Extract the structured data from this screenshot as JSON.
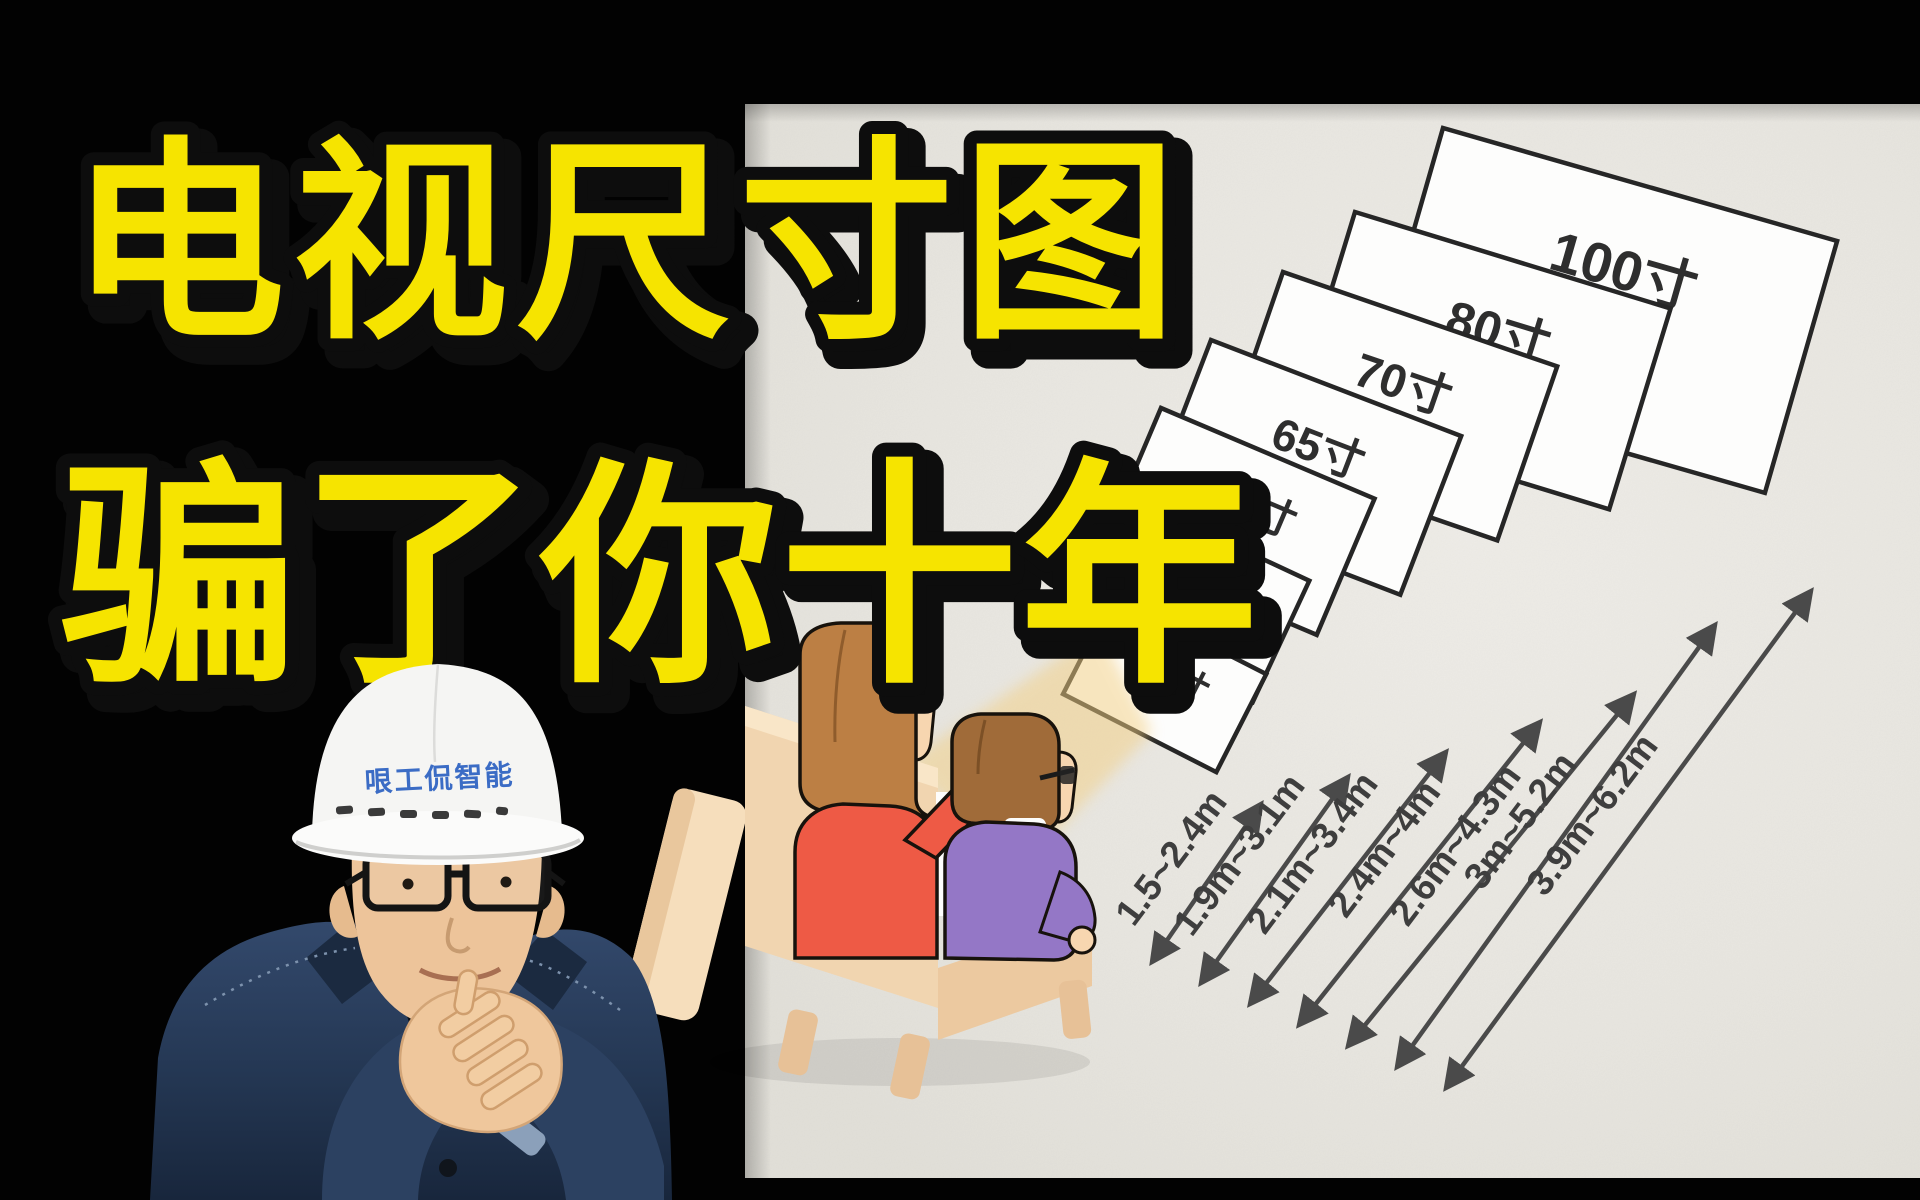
{
  "header": {
    "title_line1": "电视尺寸图",
    "title_line2": "骗了你十年"
  },
  "presenter": {
    "hard_hat_text": "哏工侃智能"
  },
  "diagram": {
    "screens": [
      {
        "size": "40寸",
        "distance": "1.5~2.4m"
      },
      {
        "size": "50寸",
        "distance": "1.9m~3.1m"
      },
      {
        "size": "55寸",
        "distance": "2.1m~3.4m"
      },
      {
        "size": "65寸",
        "distance": "2.4m~4m"
      },
      {
        "size": "70寸",
        "distance": "2.6m~4.3m"
      },
      {
        "size": "80寸",
        "distance": "3m~5.2m"
      },
      {
        "size": "100寸",
        "distance": "3.9m~6.2m"
      }
    ]
  },
  "chart_data": {
    "type": "table",
    "rows": [
      [
        "40寸",
        "1.5~2.4m"
      ],
      [
        "50寸",
        "1.9m~3.1m"
      ],
      [
        "55寸",
        "2.1m~3.4m"
      ],
      [
        "65寸",
        "2.4m~4m"
      ],
      [
        "70寸",
        "2.6m~4.3m"
      ],
      [
        "80寸",
        "3m~5.2m"
      ],
      [
        "100寸",
        "3.9m~6.2m"
      ]
    ]
  },
  "colors": {
    "background": "#000000",
    "title_yellow": "#F6E400",
    "paper": "#E9E7E1",
    "panel_white": "#FDFDFC",
    "panel_border": "#262626",
    "arrow_gray": "#4A4A4A",
    "hat_text_blue": "#3B6CC5",
    "sofa_beige": "#F1D5B0",
    "woman_shirt": "#EE5A45",
    "man_sweater": "#9477C6",
    "glow_yellow": "#F3CF82"
  }
}
